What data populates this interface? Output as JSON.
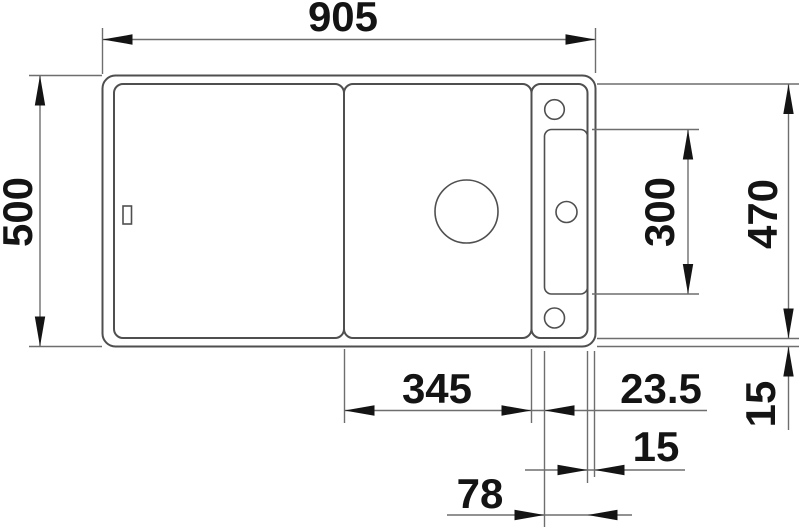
{
  "drawing": {
    "type": "technical-dimension-drawing",
    "view": "sink-top-view",
    "units_shown": false,
    "colors": {
      "background": "#ffffff",
      "outline": "#4f4f4f",
      "dimension_lines": "#6e6e6e",
      "text": "#141414"
    },
    "dims": {
      "overall_width": "905",
      "overall_depth": "500",
      "inner_depth": "470",
      "recess_length": "300",
      "board_length": "345",
      "board_to_recess_gap": "23.5",
      "recess_to_edge_gap": "15",
      "bottom_rim": "15",
      "recess_width": "78"
    }
  }
}
